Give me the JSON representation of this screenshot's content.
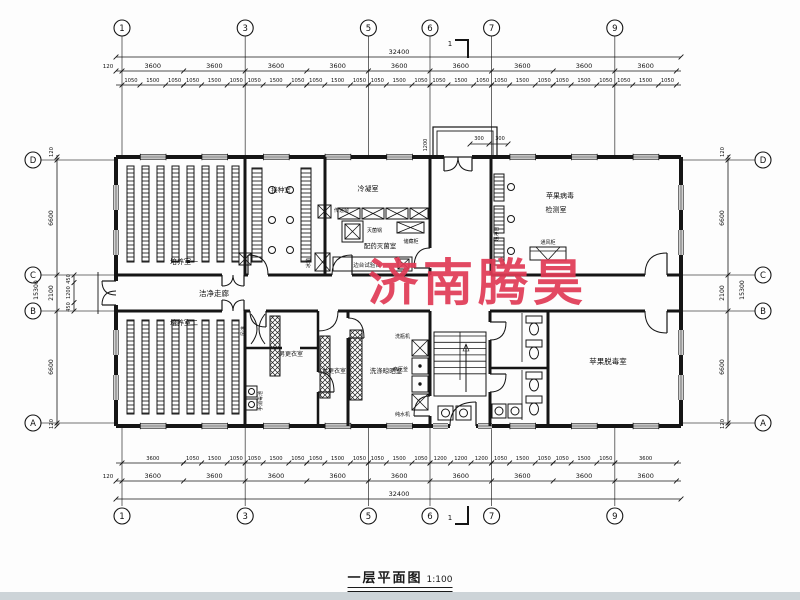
{
  "title": {
    "name": "一层平面图",
    "scale": "1:100"
  },
  "watermark": {
    "text": "济南腾昊",
    "color": "#e03a55"
  },
  "axes": {
    "horizontal": [
      "1",
      "3",
      "5",
      "6",
      "7",
      "9"
    ],
    "vertical": [
      "D",
      "C",
      "B",
      "A"
    ]
  },
  "section_mark": {
    "label": "1"
  },
  "dimensions": {
    "top": {
      "overall": "32400",
      "edge": "120",
      "bays": [
        "3600",
        "3600",
        "3600",
        "3600",
        "3600",
        "3600",
        "3600",
        "3600",
        "3600"
      ],
      "sub": [
        "1050",
        "1500",
        "1050"
      ]
    },
    "bottom": {
      "overall": "32400",
      "edge": "120",
      "bays": [
        "3600",
        "3600",
        "3600",
        "3600",
        "3600",
        "3600",
        "3600",
        "3600",
        "3600"
      ],
      "sub_rows": [
        [
          "3600"
        ],
        [
          "1050",
          "1500",
          "1050"
        ],
        [
          "1050",
          "1500",
          "1050"
        ],
        [
          "1050",
          "1500",
          "1050"
        ],
        [
          "1050",
          "1500",
          "1050"
        ],
        [
          "1200",
          "1200",
          "1200"
        ],
        [
          "1050",
          "1500",
          "1050"
        ],
        [
          "1050",
          "1500",
          "1050"
        ],
        [
          "3600"
        ]
      ]
    },
    "left": {
      "overall": "15300",
      "chain": [
        "120",
        "6600",
        "2100",
        "6600",
        "120"
      ],
      "sub": [
        "450",
        "1200",
        "450"
      ]
    },
    "right": {
      "overall": "15300",
      "chain": [
        "120",
        "6600",
        "2100",
        "6600",
        "120"
      ]
    },
    "porch": {
      "depth": "1200",
      "w1": "300",
      "w2": "300"
    }
  },
  "rooms": {
    "culture1": "培养室一",
    "inoculation": "接种室",
    "condensing": "冷凝室",
    "prep_steril": "配药灭菌室",
    "detection_line1": "苹果病毒",
    "detection_line2": "检测室",
    "clean_corridor": "洁净走廊",
    "culture2": "培养室二",
    "men_changing": "男更衣室",
    "women_changing": "女更衣室",
    "wash_dry": "洗涤晾晒室",
    "detox": "苹果脱毒室"
  },
  "equipment": {
    "sterilizer": "灭菌锅",
    "storage_cabinet": "储藏柜",
    "side_bench": "边台试验台",
    "fridge": "冰箱",
    "pass_window": "传递窗",
    "clean_bench": "超净台",
    "fume_hood": "通风柜",
    "air_shower": "风淋",
    "hand_wash": "手消毒池",
    "bottle_washer": "洗瓶机",
    "autoclave": "高压釜",
    "water_purifier": "纯水机"
  }
}
